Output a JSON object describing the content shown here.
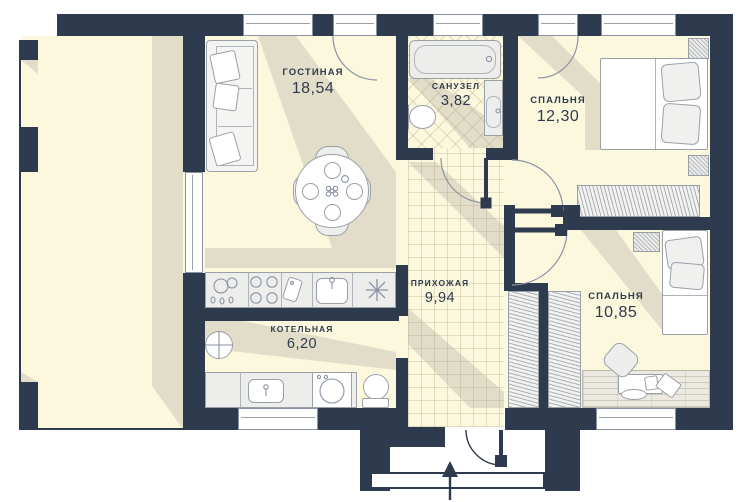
{
  "plan": {
    "type": "apartment-floor-plan",
    "rooms": [
      {
        "id": "living",
        "name": "ГОСТИНАЯ",
        "area": "18,54"
      },
      {
        "id": "bathroom",
        "name": "САНУЗЕЛ",
        "area": "3,82"
      },
      {
        "id": "bedroom1",
        "name": "СПАЛЬНЯ",
        "area": "12,30"
      },
      {
        "id": "hallway",
        "name": "ПРИХОЖАЯ",
        "area": "9,94"
      },
      {
        "id": "boiler",
        "name": "КОТЕЛЬНАЯ",
        "area": "6,20"
      },
      {
        "id": "bedroom2",
        "name": "СПАЛЬНЯ",
        "area": "10,85"
      }
    ],
    "colors": {
      "wall": "#2E3A4D",
      "floor": "#FBF8DE",
      "shadow": "#E2DDC8",
      "fixture_fill": "#EDEDEC",
      "fixture_outline": "#9AA0A8",
      "label_text": "#2E3A4D"
    },
    "icons": {
      "refrigerator_symbol": "8-point-asterisk",
      "entrance_direction": "arrow-up"
    }
  }
}
